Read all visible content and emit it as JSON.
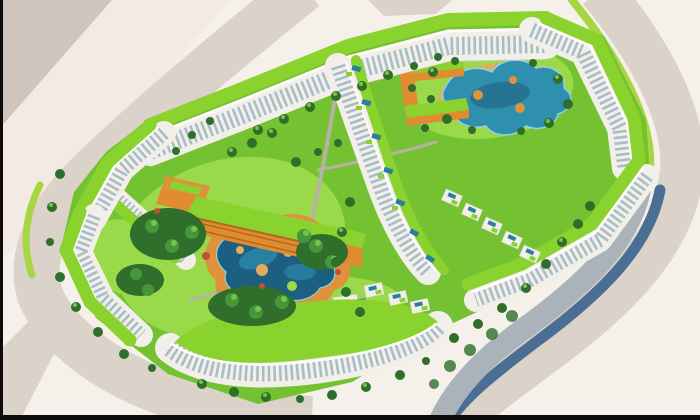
{
  "scene": {
    "type": "architectural-aerial-render",
    "description": "Aerial 3D rendering of a residential masterplan: long white apartment slabs crowned with bright green planted roofs enclose landscaped courtyards with free-form blue lagoon pools, orange low-rise clubhouse buildings with green roofs, dense tree planting, rooftop plunge pools, and surrounding beige boulevards with lime-green medians on empty off-white land.",
    "features": [
      "green-roof apartment perimeter blocks",
      "white facades with window bands",
      "central lagoon swimming pool with orange deck",
      "northeast lagoon swimming pool",
      "orange clubhouse buildings",
      "rooftop plunge pools on inner terraces",
      "villa clusters with roof pools",
      "tree-filled courtyards",
      "perimeter roads with green medians",
      "letterbox border bars"
    ]
  },
  "colors": {
    "bg": "#f6f0ea",
    "road_dark": "#cfc5bc",
    "road_cream": "#f2eae3",
    "road_mid": "#dbd2c9",
    "road_gray": "#aab3b9",
    "slate": "#4a6e94",
    "median_green": "#a8d643",
    "lawn": "#74c231",
    "lawn_light": "#9ada4a",
    "path": "#b8b1a8",
    "deck_sand": "#e3ab5e",
    "deck_orange": "#df913c",
    "pool_deep": "#1d5f80",
    "pool_mid": "#2f8fae",
    "pool_edge": "#8fd2e2",
    "pool_teal": "#2a7f9e",
    "orange": "#e08d31",
    "orange_dark": "#b2691f",
    "roof": "#8ad32f",
    "facade": "#f2efe9",
    "facade_lit": "#fdfcf8",
    "facade_shadow": "#cfcac2",
    "window": "#9db6c3",
    "tree_dark": "#2f6e2b",
    "tree_mid": "#47963a",
    "tree_light": "#78c24e",
    "tree_red": "#bf4f35",
    "letterbox": "#0b0b0b"
  }
}
